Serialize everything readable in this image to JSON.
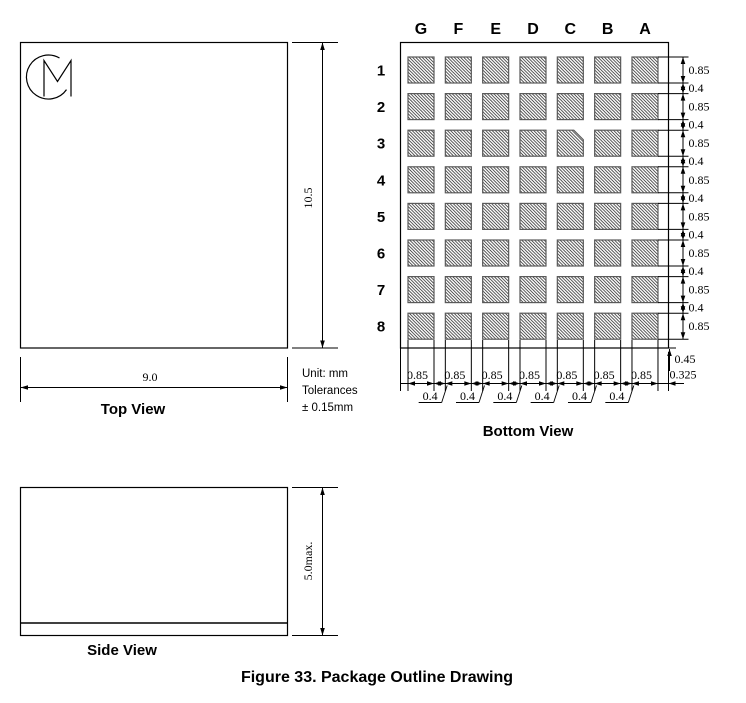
{
  "figure": {
    "caption": "Figure 33. Package Outline Drawing"
  },
  "notes": {
    "unit": "Unit: mm",
    "tolerances": "Tolerances",
    "tolerance_value": "± 0.15mm"
  },
  "top_view": {
    "label": "Top View",
    "width_dim": "9.0",
    "height_dim": "10.5",
    "logo": "CM monogram"
  },
  "side_view": {
    "label": "Side View",
    "height_dim": "5.0max."
  },
  "bottom_view": {
    "label": "Bottom View",
    "column_labels": [
      "G",
      "F",
      "E",
      "D",
      "C",
      "B",
      "A"
    ],
    "row_labels": [
      "1",
      "2",
      "3",
      "4",
      "5",
      "6",
      "7",
      "8"
    ],
    "chamfered_pad": "C3",
    "right_dim_chain": {
      "pad_heights": [
        "0.85",
        "0.85",
        "0.85",
        "0.85",
        "0.85",
        "0.85",
        "0.85",
        "0.85"
      ],
      "row_gaps": [
        "0.4",
        "0.4",
        "0.4",
        "0.4",
        "0.4",
        "0.4",
        "0.4"
      ],
      "bottom_margin": "0.45"
    },
    "bottom_dim_chain": {
      "pad_widths": [
        "0.85",
        "0.85",
        "0.85",
        "0.85",
        "0.85",
        "0.85",
        "0.85"
      ],
      "col_gaps": [
        "0.4",
        "0.4",
        "0.4",
        "0.4",
        "0.4",
        "0.4"
      ],
      "side_margin": "0.325"
    }
  },
  "colors": {
    "line": "#000000",
    "pad_border": "#5a5a5a",
    "hatch": "#2b2b2b",
    "background": "#ffffff"
  }
}
